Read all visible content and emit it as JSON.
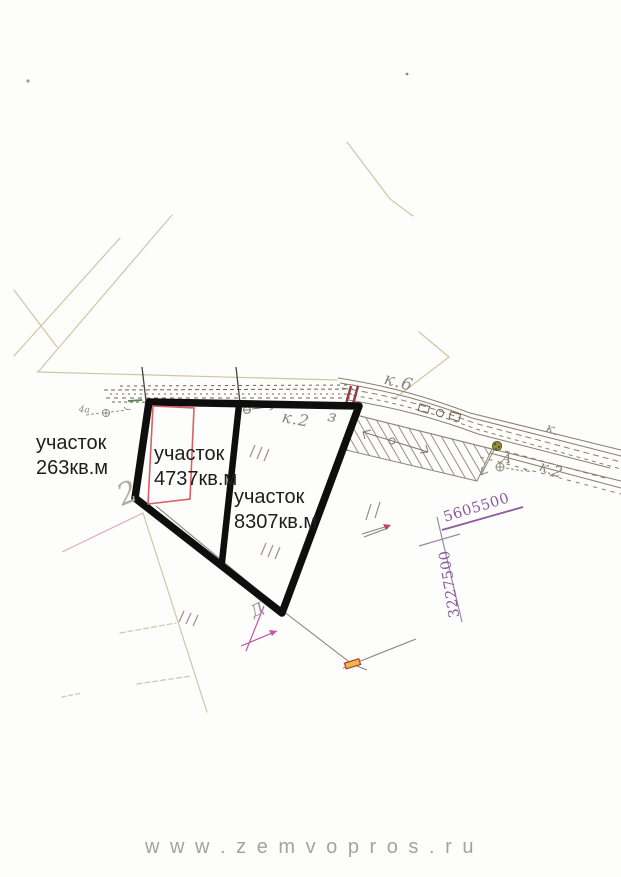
{
  "plots": [
    {
      "name": "участок",
      "area": "263кв.м"
    },
    {
      "name": "участок",
      "area": "4737кв.м"
    },
    {
      "name": "участок",
      "area": "8307кв.м"
    }
  ],
  "annotations": {
    "contour_k6": "к.6",
    "contour_k2_mid": "к.2",
    "contour_3": "з",
    "contour_k_right": "к.",
    "contour_k2_right": "к.2",
    "point_a": "А",
    "point_4a": "4а",
    "sketch_2": "2",
    "sketch_d": "Д",
    "grid_northing": "5605500",
    "grid_easting": "3227500"
  },
  "watermark": {
    "text": "w w w . z e m v o p r o s . r u"
  },
  "colors": {
    "plot_boundary": "#0e0e0e",
    "subplot_outline": "#d85f63",
    "grid_label": "#8b5aa0",
    "pencil": "#8d8379",
    "scan_line": "#d3c4a4",
    "boundary_tick": "#993647",
    "tree_symbol": "#8f8d3c",
    "magenta_mark": "#c455a8",
    "marker_fill": "#e8b84b",
    "watermark": "#a3a3a3"
  }
}
